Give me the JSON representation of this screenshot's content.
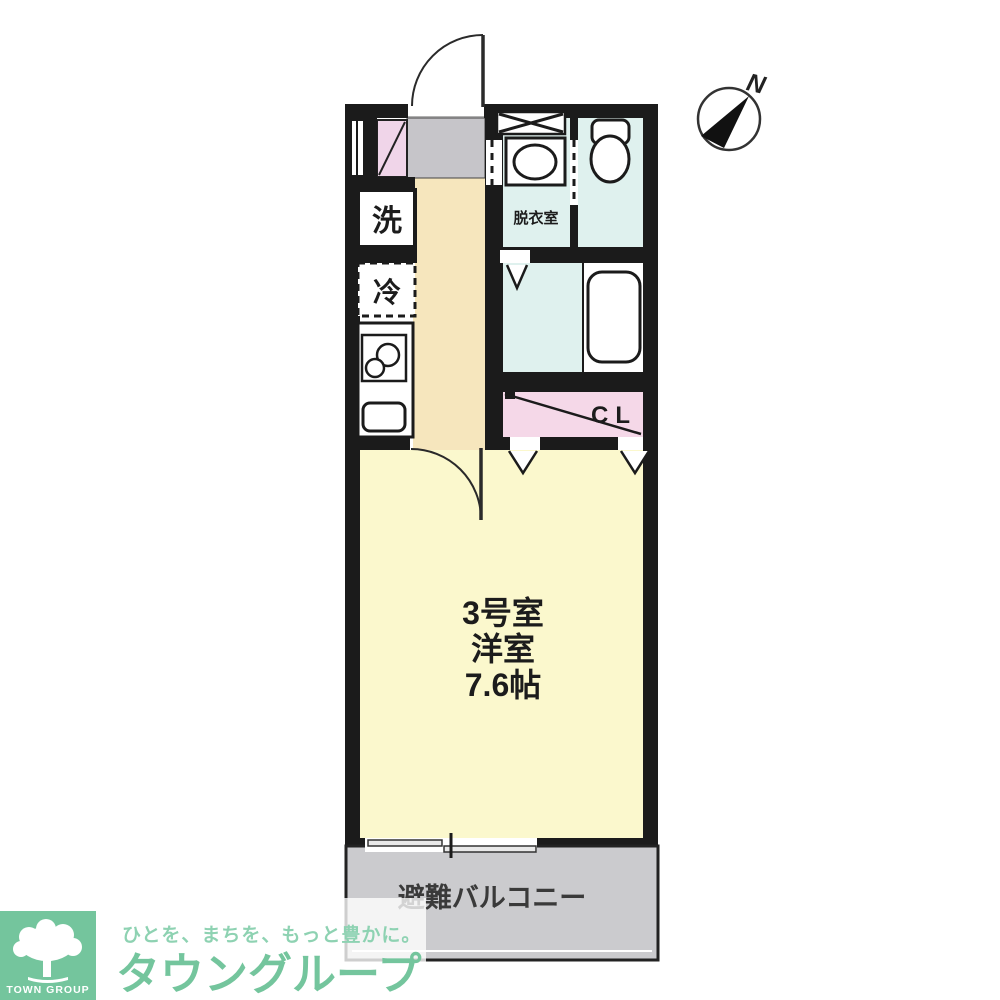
{
  "floor_plan": {
    "room_label": {
      "line1": "3号室",
      "line2": "洋室",
      "line3": "7.6帖"
    },
    "labels": {
      "washer": "洗",
      "fridge": "冷",
      "dressing_room": "脱衣室",
      "closet": "CL",
      "balcony": "避難バルコニー",
      "north": "N"
    },
    "colors": {
      "wall": "#1b1b1b",
      "corridor": "#f6e6bd",
      "main_room": "#fbf8cd",
      "wet_room": "#dff1ee",
      "closet_pink": "#f5d8e8",
      "entrance_pink": "#f0d5e9",
      "genkan_gray": "#c6c5c9",
      "balcony_gray": "#cbcbce"
    }
  },
  "branding": {
    "logo_square_label": "TOWN GROUP",
    "tagline": "ひとを、まちを、もっと豊かに。",
    "brand_name": "タウングループ",
    "brand_green": "#74c59d",
    "tagline_green": "#8ed2b2"
  }
}
